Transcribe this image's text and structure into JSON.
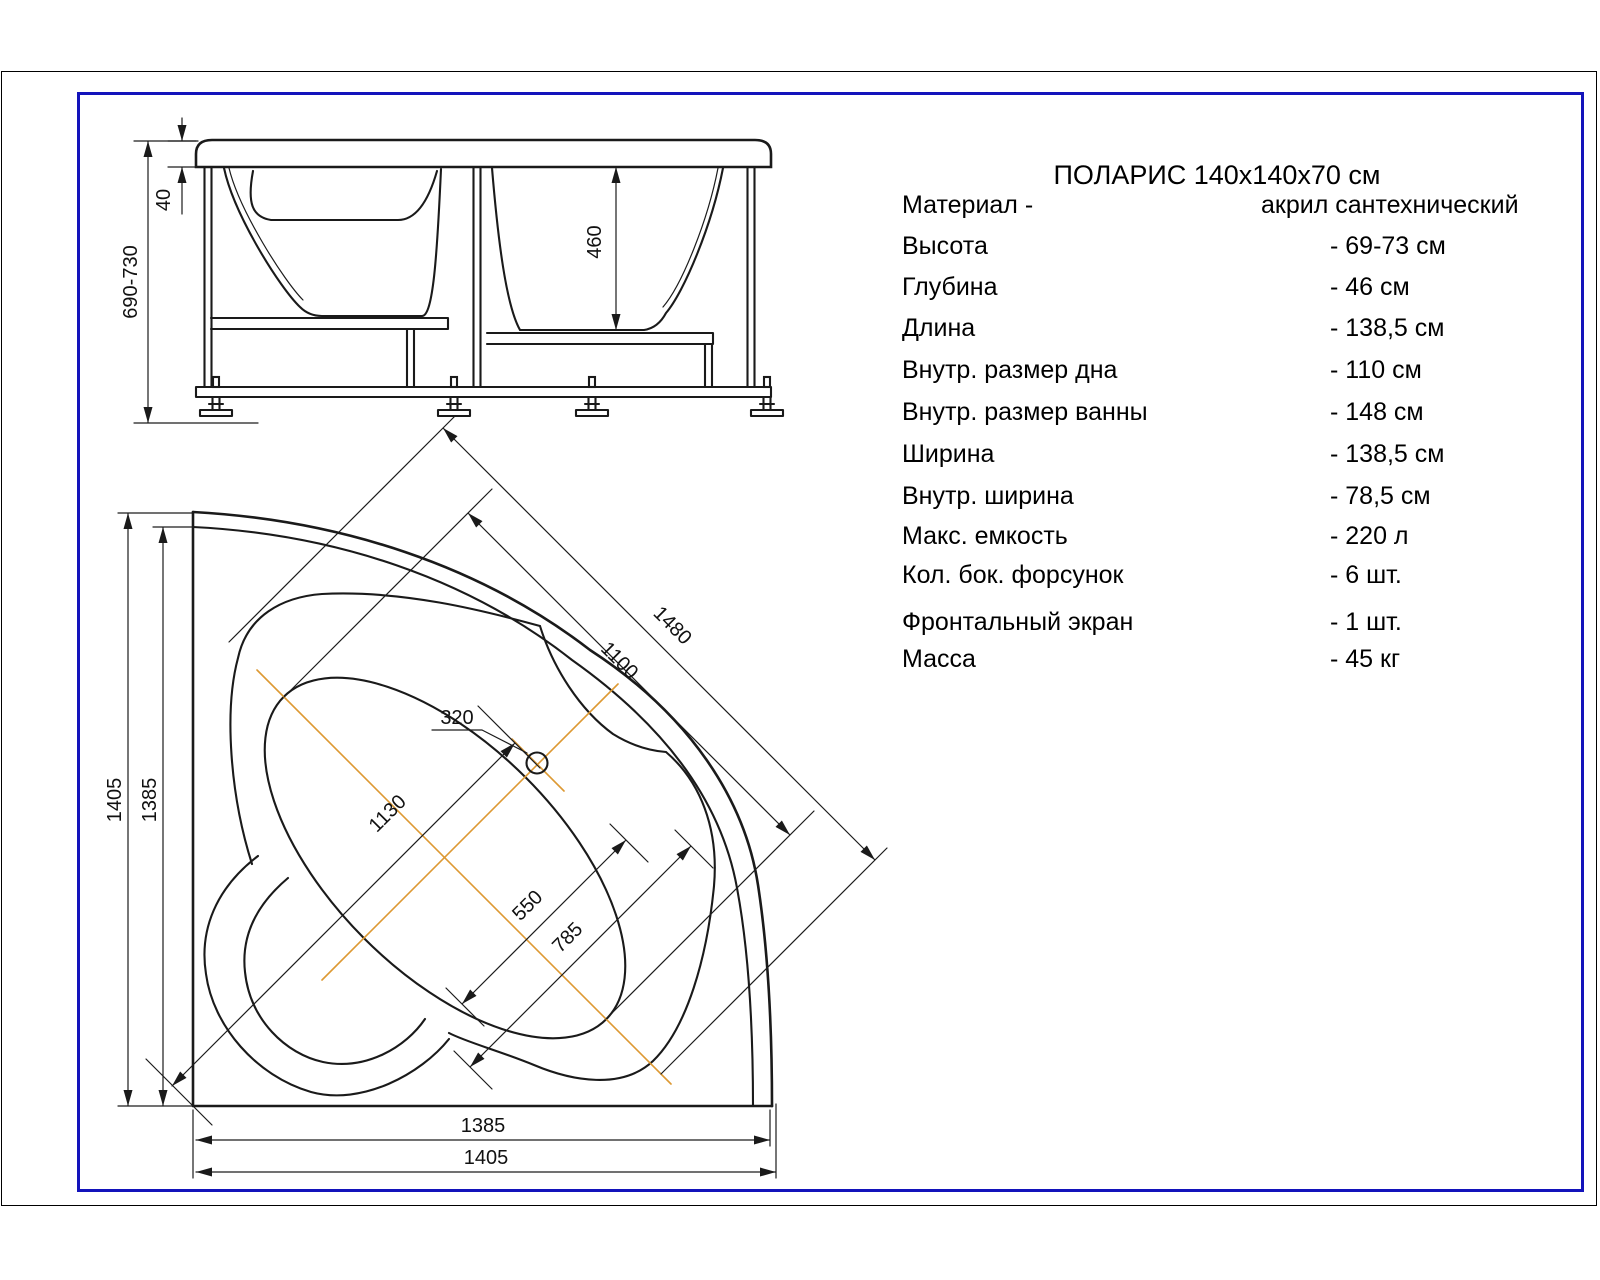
{
  "title": "ПОЛАРИС 140x140x70 см",
  "specs": [
    {
      "label": "Материал -",
      "value": "акрил сантехнический"
    },
    {
      "label": "Высота",
      "value": "- 69-73 см"
    },
    {
      "label": "Глубина",
      "value": "- 46 см"
    },
    {
      "label": "Длина",
      "value": "- 138,5 см"
    },
    {
      "label": "Внутр. размер дна",
      "value": "- 110 см"
    },
    {
      "label": "Внутр. размер ванны",
      "value": "- 148 см"
    },
    {
      "label": "Ширина",
      "value": "- 138,5 см"
    },
    {
      "label": "Внутр. ширина",
      "value": "- 78,5 см"
    },
    {
      "label": "Макс. емкость",
      "value": "- 220 л"
    },
    {
      "label": "Кол. бок. форсунок",
      "value": "- 6 шт."
    },
    {
      "label": "Фронтальный экран",
      "value": "- 1 шт."
    },
    {
      "label": "Масса",
      "value": "- 45 кг"
    }
  ],
  "front_view_dims": {
    "rim_thickness": "40",
    "height_range": "690-730",
    "depth": "460"
  },
  "plan_view_dims": {
    "left_overall": "1405",
    "left_wall": "1385",
    "diag_bath": "1480",
    "diag_bottom": "1100",
    "drain_offset": "320",
    "corner_to_drain": "1130",
    "bottom_width": "550",
    "inner_width": "785",
    "bottom_wall": "1385",
    "bottom_overall": "1405"
  },
  "colors": {
    "frame_blue": "#1313bb",
    "centerline_orange": "#dd9933",
    "line_black": "#1a1a1a"
  }
}
